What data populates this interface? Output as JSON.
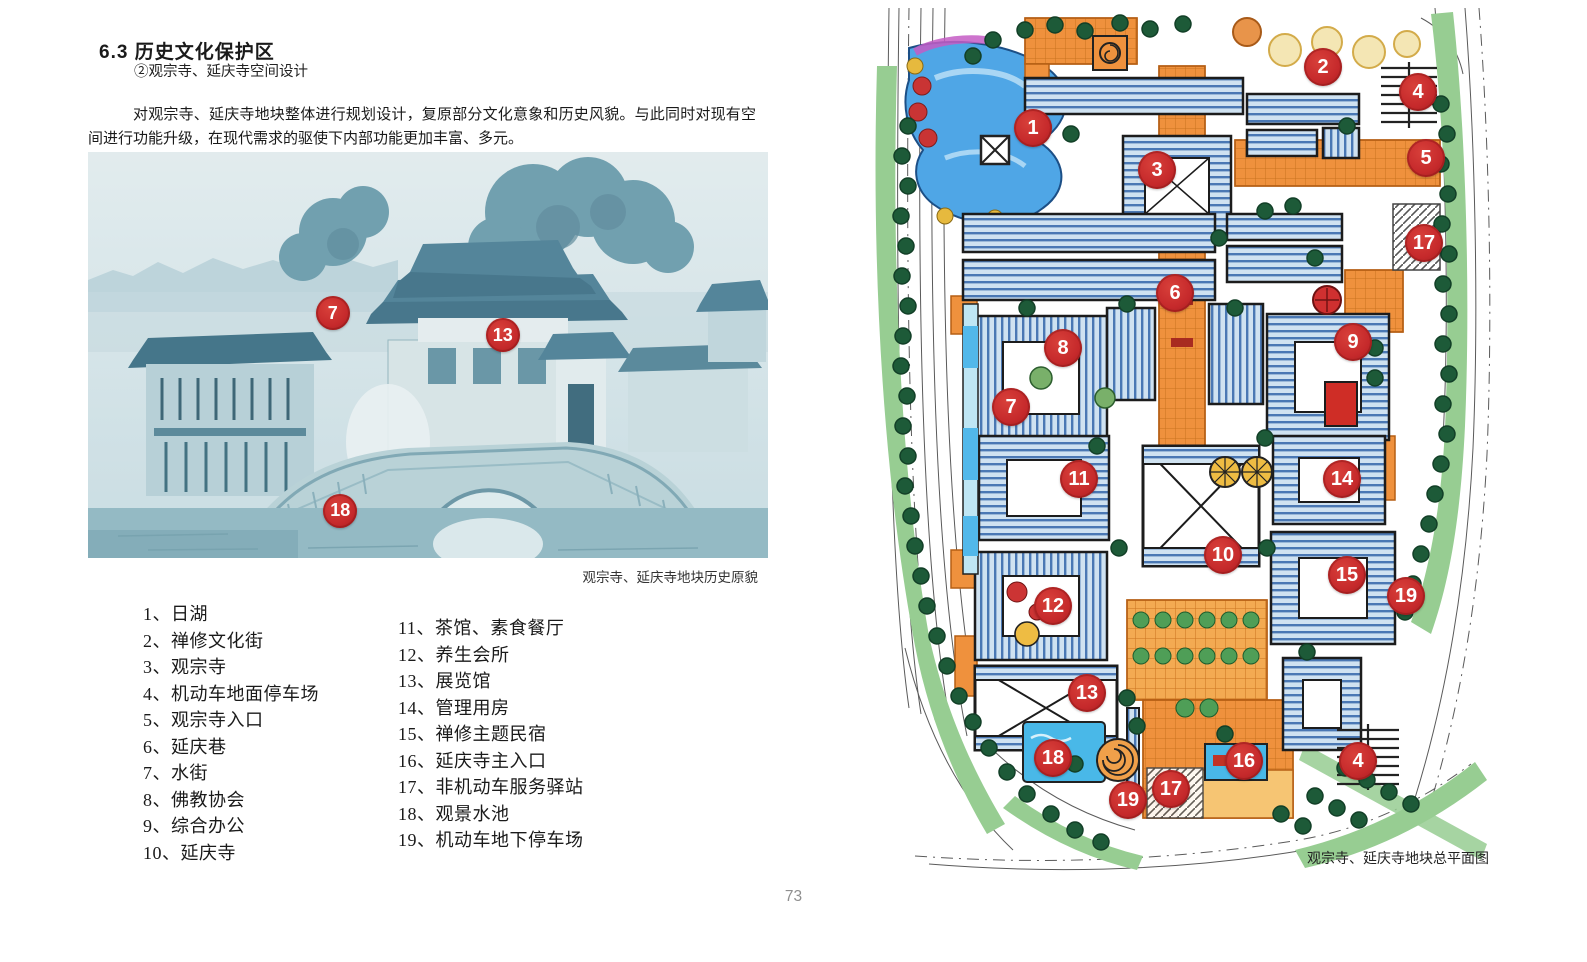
{
  "header": {
    "section_title": "6.3 历史文化保护区",
    "subtitle": "②观宗寺、延庆寺空间设计",
    "paragraph": "对观宗寺、延庆寺地块整体进行规划设计，复原部分文化意象和历史风貌。与此同时对现有空间进行功能升级，在现代需求的驱使下内部功能更加丰富、多元。"
  },
  "photo": {
    "caption": "观宗寺、延庆寺地块历史原貌",
    "markers": [
      {
        "label": "7",
        "x": 36.0,
        "y": 39.7
      },
      {
        "label": "13",
        "x": 61.0,
        "y": 45.1
      },
      {
        "label": "18",
        "x": 37.1,
        "y": 88.4
      }
    ]
  },
  "legend": {
    "left_items": [
      "1、日湖",
      "2、禅修文化街",
      "3、观宗寺",
      "4、机动车地面停车场",
      "5、观宗寺入口",
      "6、延庆巷",
      "7、水街",
      "8、佛教协会",
      "9、综合办公",
      "10、延庆寺"
    ],
    "right_items": [
      "11、茶馆、素食餐厅",
      "12、养生会所",
      "13、展览馆",
      "14、管理用房",
      "15、禅修主题民宿",
      "16、延庆寺主入口",
      "17、非机动车服务驿站",
      "18、观景水池",
      "19、机动车地下停车场"
    ]
  },
  "map": {
    "caption": "观宗寺、延庆寺地块总平面图",
    "markers": [
      {
        "label": "1",
        "x": 158,
        "y": 120
      },
      {
        "label": "2",
        "x": 448,
        "y": 59
      },
      {
        "label": "3",
        "x": 282,
        "y": 162
      },
      {
        "label": "4",
        "x": 543,
        "y": 84
      },
      {
        "label": "5",
        "x": 551,
        "y": 150
      },
      {
        "label": "17",
        "x": 549,
        "y": 235
      },
      {
        "label": "6",
        "x": 300,
        "y": 285
      },
      {
        "label": "8",
        "x": 188,
        "y": 340
      },
      {
        "label": "9",
        "x": 478,
        "y": 334
      },
      {
        "label": "7",
        "x": 136,
        "y": 399
      },
      {
        "label": "11",
        "x": 204,
        "y": 471
      },
      {
        "label": "14",
        "x": 467,
        "y": 471
      },
      {
        "label": "10",
        "x": 348,
        "y": 547
      },
      {
        "label": "15",
        "x": 472,
        "y": 567
      },
      {
        "label": "19",
        "x": 531,
        "y": 588
      },
      {
        "label": "12",
        "x": 178,
        "y": 598
      },
      {
        "label": "13",
        "x": 212,
        "y": 685
      },
      {
        "label": "18",
        "x": 178,
        "y": 750
      },
      {
        "label": "16",
        "x": 369,
        "y": 753
      },
      {
        "label": "4",
        "x": 483,
        "y": 753
      },
      {
        "label": "17",
        "x": 296,
        "y": 781
      },
      {
        "label": "19",
        "x": 253,
        "y": 792
      }
    ]
  },
  "footer": {
    "page_number": "73"
  },
  "colors": {
    "marker_red": "#c5292b",
    "marker_rim": "#9e1f1f",
    "photo_teal_dark": "#5d92a4",
    "photo_teal_light": "#dcebee",
    "map_orange": "#ef913d",
    "map_plaza_yellow": "#f3aa52",
    "map_roof_blue": "#cfe2f1",
    "map_roof_line": "#4a78b4",
    "map_water_blue": "#4fa6e6",
    "map_pool_aqua": "#49b8e8",
    "map_green_band": "#97cd92",
    "map_tree_dark": "#1d5a38"
  }
}
